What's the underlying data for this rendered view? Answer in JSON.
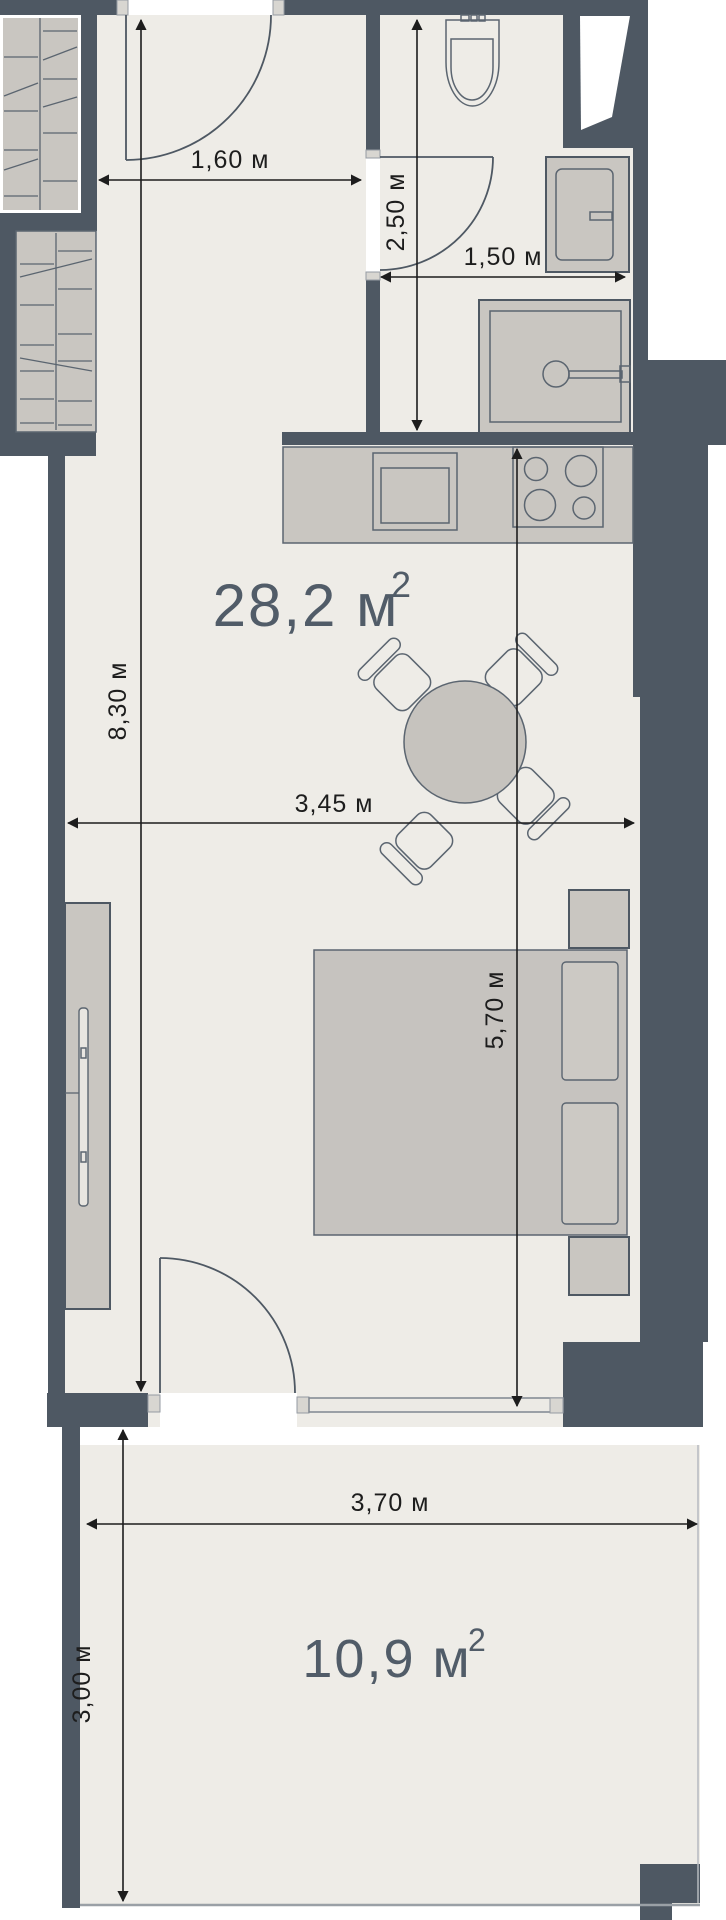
{
  "plan": {
    "type": "apartment-floor-plan",
    "areas": {
      "main": {
        "value": "28,2 м",
        "sup": "2"
      },
      "balcony": {
        "value": "10,9 м",
        "sup": "2"
      }
    },
    "dims": {
      "hall_width": "1,60 м",
      "bath_depth": "2,50 м",
      "bath_width": "1,50 м",
      "room_length": "8,30 м",
      "room_width": "3,45 м",
      "living_length": "5,70 м",
      "balcony_width": "3,70 м",
      "balcony_depth": "3,00 м"
    },
    "furniture": [
      "wardrobe",
      "wardrobe",
      "toilet",
      "washing-machine",
      "shower",
      "kitchen-counter",
      "sink",
      "stove",
      "dining-table",
      "chairs",
      "tv-sideboard",
      "tv",
      "bed",
      "pillows",
      "nightstands"
    ],
    "colors": {
      "wall": "#4e5863",
      "floor": "#eeece7",
      "furniture": "#c9c6c1",
      "dimension_text": "#1d1d1d",
      "area_text": "#515c68",
      "background": "#ffffff"
    }
  }
}
